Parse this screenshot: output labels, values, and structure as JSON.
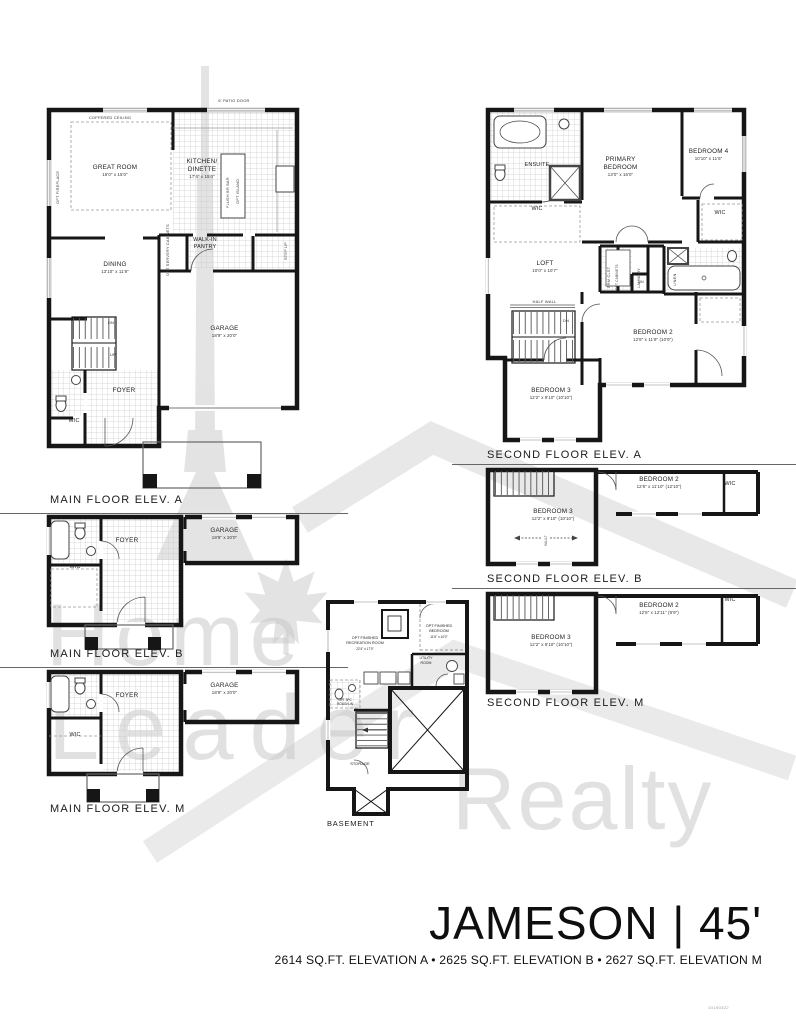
{
  "colors": {
    "wall": "#161616",
    "tile": "#cccccc",
    "watermark": "#cdcdcd",
    "text": "#1b1b1b"
  },
  "watermark": {
    "word1": "Home",
    "word2": "Leader",
    "word3": "Realty"
  },
  "footer": {
    "title": "JAMESON | 45'",
    "subtitle": "2614 SQ.FT. ELEVATION A • 2625 SQ.FT. ELEVATION B • 2627 SQ.FT. ELEVATION M",
    "code": "10190322"
  },
  "mainA": {
    "caption": "MAIN FLOOR ELEV. A",
    "coffered": "COFFERED CEILING",
    "optFireplace": "OPT FIREPLACE",
    "patioDoor": "6' PATIO DOOR",
    "greatRoom": "GREAT ROOM",
    "greatRoomDim": "15'0\" x 15'0\"",
    "kitchen": "KITCHEN/",
    "dinette": "DINETTE",
    "kitchenDim": "17'4\" x 15'0\"",
    "flushBar": "FLUSH BR BAR",
    "optIsland": "OPT ISLAND",
    "servery": "OPT SERVERY CABINETS",
    "stepUp": "STEP UP",
    "pantry1": "WALK-IN",
    "pantry2": "PANTRY",
    "dining": "DINING",
    "diningDim": "13'10\" x 11'8\"",
    "garage": "GARAGE",
    "garageDim": "18'9\" x 20'0\"",
    "foyer": "FOYER",
    "wic": "WIC",
    "up": "UP",
    "dn": "DN"
  },
  "secondA": {
    "caption": "SECOND FLOOR ELEV. A",
    "ensuite": "ENSUITE",
    "wicLeft": "WIC",
    "wicRight": "WIC",
    "primary1": "PRIMARY",
    "primary2": "BEDROOM",
    "primaryDim": "13'0\" x 16'0\"",
    "bedroom4": "BEDROOM 4",
    "bedroom4Dim": "10'10\" x 11'6\"",
    "loft": "LOFT",
    "loftDim": "10'0\" x 10'7\"",
    "halfWall": "HALF WALL",
    "brmClst": "BRM CLST",
    "optCabinets": "OPT CABINETS",
    "laundry": "LAUNDRY",
    "lin": "LIN",
    "linen": "LINEN",
    "dn": "DN",
    "bedroom2": "BEDROOM 2",
    "bedroom2Dim": "12'8\" x 11'9\" (10'9\")",
    "bedroom3": "BEDROOM 3",
    "bedroom3Dim": "12'2\" x 9'10\" (10'10\")"
  },
  "mainB": {
    "caption": "MAIN FLOOR ELEV. B",
    "foyer": "FOYER",
    "wic": "WIC",
    "garage": "GARAGE",
    "garageDim": "18'9\" x 20'0\""
  },
  "secondB": {
    "caption": "SECOND FLOOR ELEV. B",
    "bedroom2": "BEDROOM 2",
    "bedroom2Dim": "12'8\" x 11'10\" (12'10\")",
    "wic": "WIC",
    "bedroom3": "BEDROOM 3",
    "bedroom3Dim": "12'2\" x 9'10\" (10'10\")",
    "vault": "VAULT"
  },
  "mainM": {
    "caption": "MAIN FLOOR ELEV. M",
    "foyer": "FOYER",
    "wic": "WIC",
    "garage": "GARAGE",
    "garageDim": "18'9\" x 20'0\""
  },
  "secondM": {
    "caption": "SECOND FLOOR ELEV. M",
    "bedroom2": "BEDROOM 2",
    "bedroom2Dim": "12'8\" x 12'11\" (9'9\")",
    "wic": "WIC",
    "bedroom3": "BEDROOM 3",
    "bedroom3Dim": "12'2\" x 9'10\" (10'10\")"
  },
  "basement": {
    "caption": "BASEMENT",
    "rec1": "OPT FINISHED",
    "rec2": "RECREATION ROOM",
    "recDim": "22'4\" x 17'0\"",
    "bed1": "OPT FINISHED",
    "bed2": "BEDROOM",
    "bedDim": "11'6\" x 10'0\"",
    "utility1": "UTILITY",
    "utility2": "ROOM",
    "roughIn1": "OPT 3PC",
    "roughIn2": "ROUGH-IN",
    "storage": "STORAGE"
  }
}
